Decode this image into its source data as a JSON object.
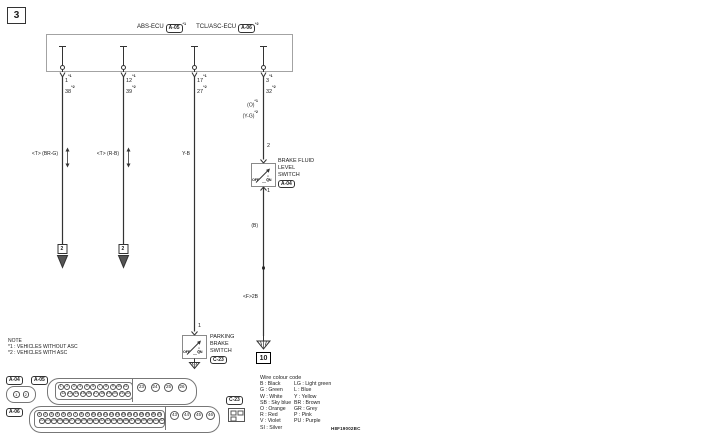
{
  "page": {
    "number": "3",
    "code": "H8F19002BC"
  },
  "header": {
    "ecu1": "ABS-ECU",
    "conn1": "A-05",
    "note1": "*1",
    "ecu2": "TCL/ASC-ECU",
    "conn2": "A-06",
    "note2": "*2"
  },
  "pins": {
    "note1": "*1",
    "note2": "*2",
    "p1a": "1",
    "p1b": "38",
    "p2a": "12",
    "p2b": "39",
    "p3a": "17",
    "p3b": "27",
    "p4a": "3",
    "p4b": "32"
  },
  "wire_labels": {
    "w1": "<T> (BR-G)",
    "w2": "<T> (R-B)",
    "w3": "Y-B",
    "w4a": "(O)",
    "w4a_note": "*1",
    "w4b": "(Y-G)",
    "w4b_note": "*2",
    "w4_mid": "(B)",
    "w4_low": "<F>2B"
  },
  "continuation": {
    "arrow1": "2",
    "arrow2": "2"
  },
  "bfl_switch": {
    "pin_top": "2",
    "pin_bottom": "1",
    "off": "OFF",
    "on": "ON",
    "line1": "BRAKE FLUID",
    "line2": "LEVEL",
    "line3": "SWITCH",
    "connector": "A-04"
  },
  "pb_switch": {
    "pin_top": "1",
    "off": "OFF",
    "on": "ON",
    "line1": "PARKING",
    "line2": "BRAKE",
    "line3": "SWITCH",
    "connector": "C-23"
  },
  "ground": {
    "id": "10"
  },
  "note": {
    "title": "NOTE",
    "lines": [
      "*1 : VEHICLES WITHOUT ASC",
      "*2 : VEHICLES WITH ASC"
    ]
  },
  "connectors": {
    "a04": {
      "label": "A-04",
      "pins": [
        "1",
        "2"
      ]
    },
    "a05": {
      "label": "A-05",
      "row1": [
        "1",
        "2",
        "3",
        "4",
        "5",
        "6",
        "7",
        "8",
        "9",
        "10",
        "11"
      ],
      "row2": [
        "12",
        "13",
        "14",
        "15",
        "16",
        "17",
        "18",
        "19",
        "20",
        "21",
        "22"
      ],
      "large": [
        "23",
        "24",
        "25",
        "26"
      ]
    },
    "a06": {
      "label": "A-06",
      "row1": [
        "1",
        "2",
        "3",
        "4",
        "5",
        "6",
        "7",
        "8",
        "9",
        "10",
        "11",
        "12",
        "13",
        "14",
        "15",
        "16",
        "17",
        "18",
        "19",
        "20",
        "21"
      ],
      "row2": [
        "22",
        "23",
        "24",
        "25",
        "26",
        "27",
        "28",
        "29",
        "30",
        "31",
        "32",
        "33",
        "34",
        "35",
        "36",
        "37",
        "38",
        "39",
        "40",
        "41",
        "42"
      ],
      "large": [
        "43",
        "44",
        "45",
        "46"
      ]
    },
    "c23": {
      "label": "C-23"
    }
  },
  "legend": {
    "title": "Wire colour code",
    "rows": [
      {
        "c1": "B : Black",
        "c2": "LG : Light green"
      },
      {
        "c1": "G : Green",
        "c2": "L : Blue"
      },
      {
        "c1": "W : White",
        "c2": "Y : Yellow"
      },
      {
        "c1": "SB : Sky blue",
        "c2": "BR : Brown"
      },
      {
        "c1": "O : Orange",
        "c2": "GR : Grey"
      },
      {
        "c1": "R : Red",
        "c2": "P : Pink"
      },
      {
        "c1": "V : Violet",
        "c2": "PU : Purple"
      },
      {
        "c1": "SI : Silver",
        "c2": ""
      }
    ]
  }
}
